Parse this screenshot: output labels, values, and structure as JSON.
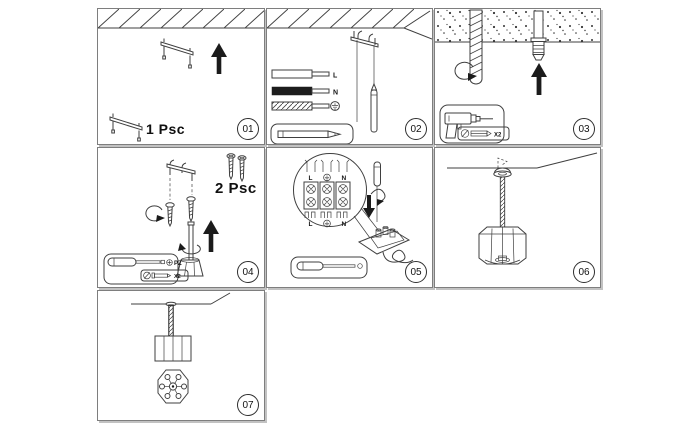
{
  "steps": [
    {
      "badge": "01",
      "qty": "1 Psc"
    },
    {
      "badge": "02",
      "wire_live": "L",
      "wire_neutral": "N"
    },
    {
      "badge": "03",
      "anchor_qty": "X2"
    },
    {
      "badge": "04",
      "qty": "2 Psc",
      "driver": "PZ",
      "screw_qty": "X2"
    },
    {
      "badge": "05",
      "top_live": "L",
      "top_neutral": "N",
      "bot_live": "L",
      "bot_neutral": "N"
    },
    {
      "badge": "06"
    },
    {
      "badge": "07"
    }
  ]
}
